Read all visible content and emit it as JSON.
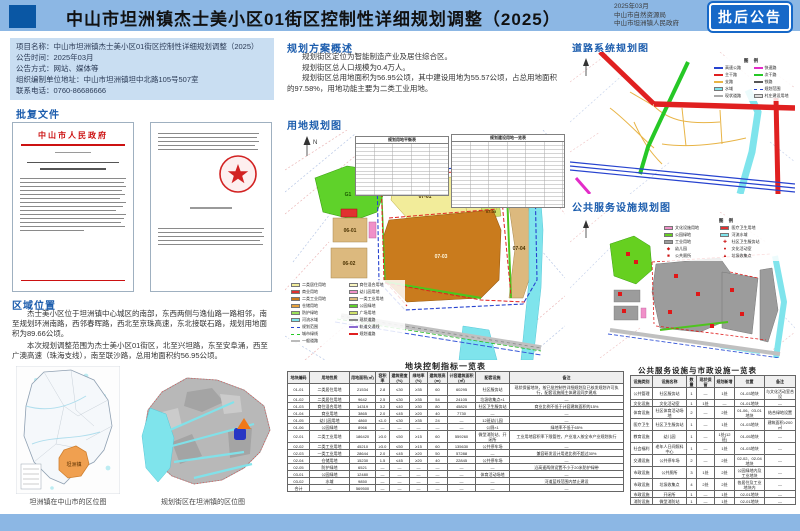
{
  "colors": {
    "band": "#8cb7e4",
    "logo": "#0a57a4",
    "badge": "#1668c8",
    "heading": "#1b5cad",
    "infobox": "#c9def2",
    "red": "#cc1111",
    "yellow": "#f2ec9a",
    "lightyellow": "#f8f4c0",
    "orange": "#c97b1d",
    "tan": "#dcb97e",
    "redparcel": "#e03030",
    "pink": "#f090c8",
    "green": "#5fd22a",
    "ygreen": "#cfe06a",
    "cyan": "#7fe4ec",
    "grayparcel": "#9c9c9c",
    "roadred": "#e02020",
    "roadgreen": "#26c826",
    "roadblue": "#2743cf",
    "roadmagenta": "#e32cc8",
    "roadyellow": "#e8b446",
    "grayroad": "#c0c0c0",
    "orangeloc": "#f0a050",
    "towngray": "#b8b8b8",
    "markerblue": "#2736c4",
    "markerorange": "#f07818"
  },
  "header": {
    "title": "中山市坦洲镇杰士美小区01街区控制性详细规划调整（2025）",
    "date": "2025年03月",
    "org1": "中山市自然资源局",
    "org2": "中山市坦洲镇人民政府",
    "badge": "批后公告"
  },
  "info_box": {
    "lines": [
      "项目名称：中山市坦洲镇杰士美小区01街区控制性详细规划调整（2025）",
      "公告时间：2025年03月",
      "公告方式：网站、媒体等",
      "组织编制单位地址：中山市坦洲镇坦中北路105号507室",
      "联系电话：0760-86686666"
    ]
  },
  "approval": {
    "heading": "批复文件",
    "doc_title": "中山市人民政府"
  },
  "region": {
    "heading": "区域位置",
    "para1": "杰士美小区位于坦洲镇中心城区的南部，东西两侧与逸仙路一路相邻，南至规划环洲南路，西邻春晖路，西北至京珠高速，东北接联石路，规划用地面积为89.66公顷。",
    "para2": "本次规划调整范围为杰士美小区01街区，北至兴坦路，东至安阜涌，西至广澳高速（珠海支线），南至联沙路，总用地面积约56.95公顷。",
    "caption_city": "坦洲镇在中山市的区位图",
    "caption_town": "规划街区在坦洲镇的区位图",
    "city_label": "坦洲镇"
  },
  "overview": {
    "heading": "规划方案概述",
    "lines": [
      "规划街区定位为智能制造产业及居住综合区。",
      "规划街区总人口规模为0.4万人。",
      "规划街区总用地面积为56.95公顷，其中建设用地为55.57公顷，占总用地面积的97.58%，用地功能主要为二类工业用地。"
    ]
  },
  "landuse_map": {
    "heading": "用地规划图",
    "mini_table_titles": [
      "规划用地平衡表",
      "规划建设用地一览表"
    ],
    "labels": {
      "g": "G1",
      "p1": "07-01",
      "p2": "07-02",
      "p3": "07-03",
      "p4": "07-04",
      "p5": "07-05",
      "t1": "06-01",
      "t2": "06-02"
    },
    "north": "N",
    "legend_left": [
      {
        "c": "#f2ec9a",
        "t": "二类居住用地"
      },
      {
        "c": "#f8f4c0",
        "t": "商住混合用地"
      },
      {
        "c": "#e03030",
        "t": "商业用地"
      },
      {
        "c": "#f090c8",
        "t": "幼儿园用地"
      },
      {
        "c": "#c97b1d",
        "t": "二类工业用地"
      },
      {
        "c": "#dcb97e",
        "t": "一类工业用地"
      },
      {
        "c": "#e8a23c",
        "t": "仓储用地"
      },
      {
        "c": "#5fd22a",
        "t": "公园绿地"
      },
      {
        "c": "#9be05a",
        "t": "防护绿地"
      }
    ],
    "legend_right": [
      {
        "c": "#cfe06a",
        "t": "广场用地"
      },
      {
        "c": "#7fe4ec",
        "t": "河流水域"
      },
      {
        "s": "line",
        "c": "#888888",
        "t": "现状道路"
      },
      {
        "s": "dash",
        "c": "#2743cf",
        "t": "规划范围"
      },
      {
        "s": "line",
        "c": "#8a6ad0",
        "t": "轨道交通线"
      },
      {
        "s": "dash",
        "c": "#26c826",
        "t": "城市绿线"
      },
      {
        "s": "line",
        "c": "#e02020",
        "t": "规划道路"
      },
      {
        "s": "line",
        "c": "#bbbbbb",
        "t": "一般道路"
      }
    ]
  },
  "road_map": {
    "heading": "道路系统规划图",
    "legend_title": "图 例",
    "legend_left": [
      {
        "s": "line",
        "c": "#2743cf",
        "t": "高速公路"
      },
      {
        "s": "line",
        "c": "#e32cc8",
        "t": "快速路"
      },
      {
        "s": "line",
        "c": "#e02020",
        "t": "主干路"
      },
      {
        "s": "line",
        "c": "#26c826",
        "t": "次干路"
      },
      {
        "s": "line",
        "c": "#e8b446",
        "t": "支路"
      }
    ],
    "legend_right": [
      {
        "s": "line",
        "c": "#555555",
        "t": "铁路"
      },
      {
        "c": "#7fe4ec",
        "t": "水域"
      },
      {
        "s": "dash",
        "c": "#2743cf",
        "t": "规划范围"
      },
      {
        "s": "line",
        "c": "#aaaaaa",
        "t": "现状道路"
      },
      {
        "c": "#dddddd",
        "t": "村庄建设用地"
      }
    ]
  },
  "facilities_map": {
    "heading": "公共服务设施规划图",
    "legend_title": "图 例",
    "legend_left": [
      {
        "c": "#f090c8",
        "t": "文化设施用地"
      },
      {
        "c": "#e03030",
        "t": "医疗卫生用地"
      },
      {
        "c": "#66d020",
        "t": "公园绿地"
      },
      {
        "c": "#7fe4ec",
        "t": "河流水域"
      },
      {
        "c": "#9c9c9c",
        "t": "工业用地"
      }
    ],
    "legend_right": [
      {
        "sym": "✚",
        "t": "社区卫生服务站"
      },
      {
        "sym": "◆",
        "t": "幼儿园"
      },
      {
        "sym": "●",
        "t": "文化活动室"
      },
      {
        "sym": "■",
        "t": "公共厕所"
      },
      {
        "sym": "▲",
        "t": "垃圾收集点"
      }
    ]
  },
  "block_table": {
    "title": "地块控制指标一览表",
    "col_widths": [
      22,
      40,
      26,
      14,
      20,
      18,
      20,
      28,
      34,
      114
    ],
    "columns": [
      "地块编码",
      "用地性质",
      "用地面积(㎡)",
      "容积率",
      "建筑密度(%)",
      "绿地率(%)",
      "建筑限高(m)",
      "计容建筑面积(㎡)",
      "配套设施",
      "备注"
    ],
    "rows": [
      [
        "01-01",
        "二类居住用地",
        "21534",
        "2.8",
        "≤30",
        "≥35",
        "60",
        "60295",
        "社区服务站",
        "现状保留地块，按已批控制性详细规划及已核发规划许可执行，配套设施随主体建设同步建成"
      ],
      [
        "01-02",
        "二类居住用地",
        "9642",
        "2.5",
        "≤30",
        "≥35",
        "54",
        "24105",
        "垃圾收集点×1",
        "—"
      ],
      [
        "01-03",
        "商住混合用地",
        "14319",
        "3.2",
        "≤40",
        "≥30",
        "80",
        "45820",
        "社区卫生服务站",
        "商业比例不低于计容建筑面积的15%"
      ],
      [
        "01-04",
        "商业用地",
        "3865",
        "2.0",
        "≤45",
        "≥20",
        "40",
        "7730",
        "—",
        "—"
      ],
      [
        "01-05",
        "幼儿园用地",
        "4860",
        "≤1.0",
        "≤30",
        "≥35",
        "24",
        "—",
        "12班幼儿园",
        "—"
      ],
      [
        "01-06",
        "公园绿地",
        "8966",
        "—",
        "—",
        "—",
        "—",
        "—",
        "公厕×1",
        "绿地率不低于65%"
      ],
      [
        "02-01",
        "二类工业用地",
        "186420",
        "≥3.0",
        "≤50",
        "≥15",
        "60",
        "559260",
        "微型消防站、开闭所",
        "工业用地容积率下限管控，产业准入按全市产业规划执行"
      ],
      [
        "02-02",
        "二类工业用地",
        "45210",
        "≥3.0",
        "≤50",
        "≥15",
        "60",
        "135630",
        "公共停车场",
        "—"
      ],
      [
        "02-03",
        "一类工业用地",
        "28644",
        "2.0",
        "≤45",
        "≥20",
        "50",
        "57288",
        "—",
        "兼容研发设计用途比例不超过30%"
      ],
      [
        "02-04",
        "仓储用地",
        "15230",
        "1.5",
        "≤45",
        "≥20",
        "40",
        "22845",
        "公共停车场",
        "—"
      ],
      [
        "02-05",
        "防护绿地",
        "6521",
        "—",
        "—",
        "—",
        "—",
        "—",
        "—",
        "沿高速两侧设置不小于20米防护绿带"
      ],
      [
        "03-01",
        "公园绿地",
        "12480",
        "—",
        "—",
        "—",
        "—",
        "—",
        "体育活动场地",
        "—"
      ],
      [
        "03-02",
        "水域",
        "9850",
        "—",
        "—",
        "—",
        "—",
        "—",
        "—",
        "河道蓝线范围内禁止建设"
      ],
      [
        "合计",
        "—",
        "569500",
        "—",
        "—",
        "—",
        "—",
        "—",
        "—",
        "—"
      ]
    ]
  },
  "facilities_table": {
    "title": "公共服务设施与市政设施一览表",
    "col_widths": [
      22,
      34,
      10,
      18,
      20,
      30,
      31
    ],
    "columns": [
      "设施类别",
      "设施名称",
      "数量",
      "现状保留",
      "规划新增",
      "位置",
      "备注"
    ],
    "rows": [
      [
        "公共管理",
        "社区服务站",
        "1",
        "—",
        "1处",
        "01-03地块",
        "与文化活动室合设"
      ],
      [
        "文化设施",
        "文化活动室",
        "1",
        "1处",
        "—",
        "01-01地块",
        "—"
      ],
      [
        "体育设施",
        "社区体育活动场地",
        "2",
        "—",
        "2处",
        "01-06、03-01地块",
        "结合绿地设置"
      ],
      [
        "医疗卫生",
        "社区卫生服务站",
        "1",
        "—",
        "1处",
        "01-03地块",
        "建筑面积≥200㎡"
      ],
      [
        "教育设施",
        "幼儿园",
        "1",
        "—",
        "1处(12班)",
        "01-05地块",
        "—"
      ],
      [
        "社会福利",
        "老年人日间照料中心",
        "1",
        "—",
        "1处",
        "01-03地块",
        "—"
      ],
      [
        "交通设施",
        "公共停车场",
        "2",
        "—",
        "2处",
        "02-02、02-04地块",
        "—"
      ],
      [
        "市政设施",
        "公共厕所",
        "3",
        "1处",
        "2处",
        "公园绿地内及工业地块",
        "—"
      ],
      [
        "市政设施",
        "垃圾收集点",
        "4",
        "2处",
        "2处",
        "各居住及工业地块内",
        "—"
      ],
      [
        "市政设施",
        "开闭所",
        "1",
        "—",
        "1处",
        "02-01地块",
        "—"
      ],
      [
        "消防设施",
        "微型消防站",
        "1",
        "—",
        "1处",
        "02-01地块",
        "—"
      ]
    ]
  }
}
